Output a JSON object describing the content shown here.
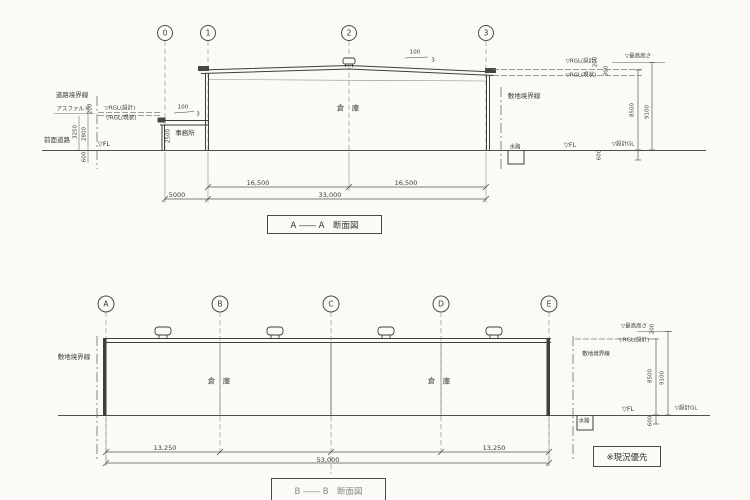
{
  "colors": {
    "paper": "#fbfaf7",
    "ink": "#3e3e3e",
    "light_line": "#9a9a9a"
  },
  "top": {
    "title": "A ―― A　断面図",
    "grids": [
      "0",
      "1",
      "2",
      "3"
    ],
    "labels": {
      "road_boundary": "道路境界線",
      "pavement": "アスファルト",
      "rgl_design_l": "▽RGL(設計)",
      "rgl_existing_l": "▽RGL(現状)",
      "front_road": "前面道路",
      "fl_l": "▽FL",
      "office": "事務所",
      "warehouse": "倉　庫",
      "site_boundary": "敷地境界線",
      "rgl_design_r": "▽RGL(設計)",
      "rgl_existing_r": "▽RGL(現状)",
      "max_height": "▽最高高さ",
      "fl_r": "▽FL",
      "design_gl": "▽設計GL",
      "waterway": "水路"
    },
    "dims": {
      "d200_l": "200",
      "d3250": "3250",
      "d2800": "2800",
      "d600_l": "600",
      "d2500": "2500",
      "office_slope_run": "100",
      "office_slope_rise": "3",
      "roof_slope_run": "100",
      "roof_slope_rise": "3",
      "d200_r": "200",
      "d300_r": "300",
      "d8500": "8500",
      "d9100": "9100",
      "d600_r": "600",
      "span_left": "16,500",
      "span_right": "16,500",
      "office_span": "5000",
      "total": "33,000"
    }
  },
  "bottom": {
    "title": "B ―― B　断面図",
    "grids": [
      "A",
      "B",
      "C",
      "D",
      "E"
    ],
    "labels": {
      "site_boundary_l": "敷地境界線",
      "warehouse_1": "倉　庫",
      "warehouse_2": "倉　庫",
      "site_boundary_r": "敷地境界線",
      "max_height": "▽最高高さ",
      "rgl_design": "▽RGL(設計)",
      "fl": "▽FL",
      "design_gl": "▽設計GL",
      "waterway": "水路",
      "note": "※現況優先"
    },
    "dims": {
      "span_ab": "13,250",
      "span_de": "13,250",
      "total": "53,000",
      "d200": "200",
      "d8500": "8500",
      "d9100": "9100",
      "d600": "600"
    }
  }
}
